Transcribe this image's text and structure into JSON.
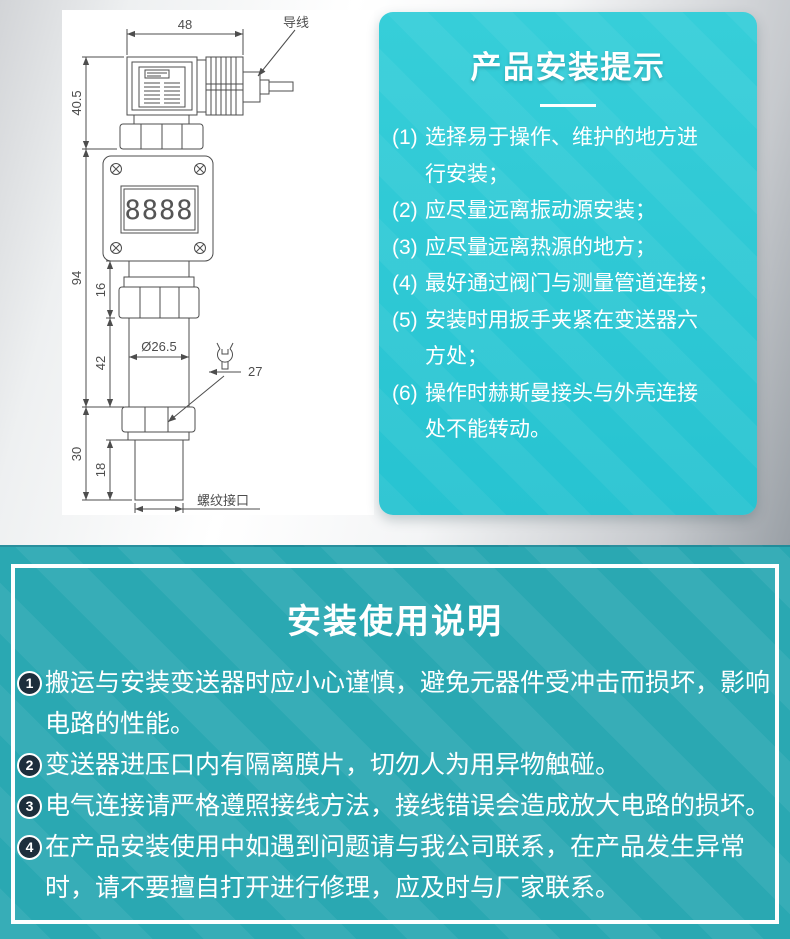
{
  "colors": {
    "tips_panel_teal": "#2cc8d4",
    "bottom_section_teal": "#2aa8b2",
    "badge_navy": "#1d2e3c",
    "text_white": "#ffffff",
    "drawing_line_gray": "#4d4d4d"
  },
  "diagram": {
    "display_value": "8888",
    "wire_label": "导线",
    "thread_label": "螺纹接口",
    "dims": {
      "top_width": "48",
      "upper_height": "40.5",
      "body_height": "94",
      "neck_height": "16",
      "cylinder_height": "42",
      "lower_height": "30",
      "thread_height": "18",
      "diameter": "Ø26.5",
      "wrench_size": "27"
    }
  },
  "tips_panel": {
    "title": "产品安装提示",
    "items": [
      {
        "num": "(1)",
        "lines": [
          "选择易于操作、维护的地方进",
          "行安装；"
        ]
      },
      {
        "num": "(2)",
        "lines": [
          "应尽量远离振动源安装；"
        ]
      },
      {
        "num": "(3)",
        "lines": [
          "应尽量远离热源的地方；"
        ]
      },
      {
        "num": "(4)",
        "lines": [
          "最好通过阀门与测量管道连接；"
        ]
      },
      {
        "num": "(5)",
        "lines": [
          "安装时用扳手夹紧在变送器六",
          "方处；"
        ]
      },
      {
        "num": "(6)",
        "lines": [
          "操作时赫斯曼接头与外壳连接",
          "处不能转动。"
        ]
      }
    ]
  },
  "instructions": {
    "title": "安装使用说明",
    "items": [
      {
        "num": "1",
        "lines": [
          "搬运与安装变送器时应小心谨慎，避免元器件受冲击而损坏，影响",
          "电路的性能。"
        ]
      },
      {
        "num": "2",
        "lines": [
          "变送器进压口内有隔离膜片，切勿人为用异物触碰。"
        ]
      },
      {
        "num": "3",
        "lines": [
          "电气连接请严格遵照接线方法，接线错误会造成放大电路的损坏。"
        ]
      },
      {
        "num": "4",
        "lines": [
          "在产品安装使用中如遇到问题请与我公司联系，在产品发生异常",
          "时，请不要擅自打开进行修理，应及时与厂家联系。"
        ]
      }
    ]
  }
}
